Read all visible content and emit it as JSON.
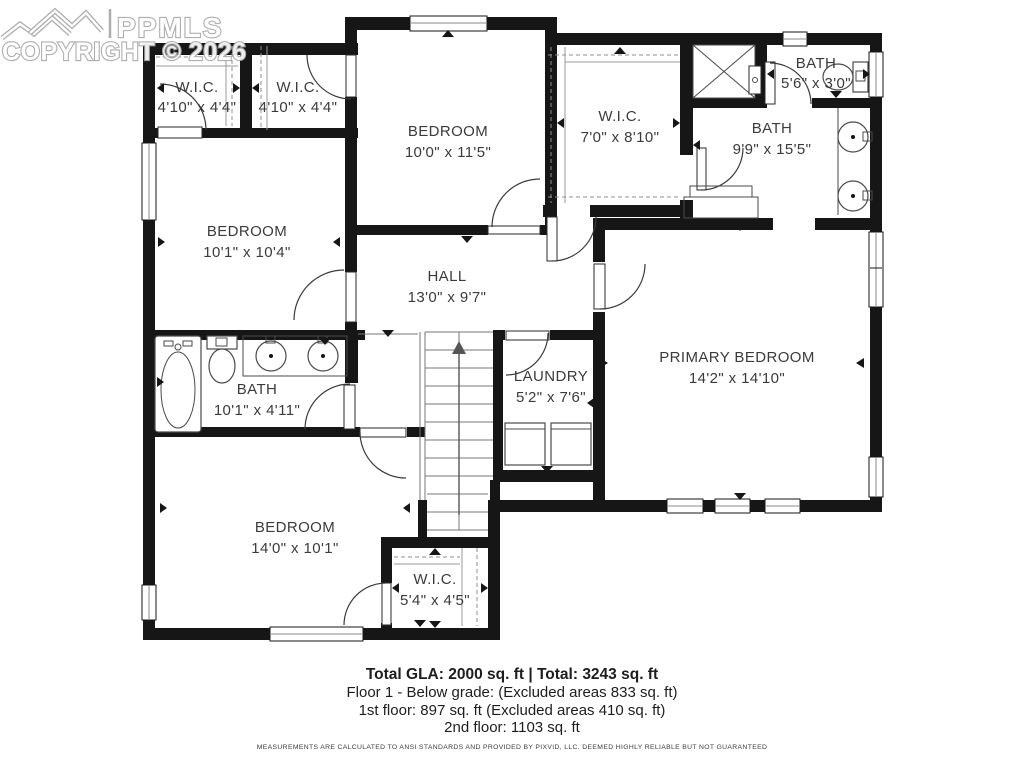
{
  "watermark": {
    "brand": "PPMLS",
    "copyright": "COPYRIGHT © 2026"
  },
  "rooms": {
    "wic1": {
      "name": "W.I.C.",
      "dims": "4'10\" x 4'4\""
    },
    "wic2": {
      "name": "W.I.C.",
      "dims": "4'10\" x 4'4\""
    },
    "bedroom_top": {
      "name": "BEDROOM",
      "dims": "10'0\" x 11'5\""
    },
    "wic3": {
      "name": "W.I.C.",
      "dims": "7'0\" x 8'10\""
    },
    "bath_small": {
      "name": "BATH",
      "dims": "5'6\" x 3'0\""
    },
    "bath_big": {
      "name": "BATH",
      "dims": "9'9\" x 15'5\""
    },
    "bedroom_left": {
      "name": "BEDROOM",
      "dims": "10'1\" x 10'4\""
    },
    "hall": {
      "name": "HALL",
      "dims": "13'0\" x 9'7\""
    },
    "primary": {
      "name": "PRIMARY BEDROOM",
      "dims": "14'2\" x 14'10\""
    },
    "bath_left": {
      "name": "BATH",
      "dims": "10'1\" x 4'11\""
    },
    "laundry": {
      "name": "LAUNDRY",
      "dims": "5'2\" x 7'6\""
    },
    "bedroom_bottom": {
      "name": "BEDROOM",
      "dims": "14'0\" x 10'1\""
    },
    "wic4": {
      "name": "W.I.C.",
      "dims": "5'4\" x 4'5\""
    }
  },
  "summary": {
    "totals": "Total GLA: 2000 sq. ft | Total: 3243 sq. ft",
    "line1": "Floor 1 - Below grade: (Excluded areas 833 sq. ft)",
    "line2": "1st floor: 897 sq. ft (Excluded areas 410 sq. ft)",
    "line3": "2nd floor: 1103 sq. ft"
  },
  "disclaimer": "MEASUREMENTS ARE CALCULATED TO ANSI STANDARDS AND PROVIDED BY PIXVID, LLC. DEEMED HIGHLY RELIABLE BUT NOT GUARANTEED",
  "colors": {
    "wall": "#161616",
    "label": "#3b3b3b",
    "watermark": "#a8a8a8"
  }
}
